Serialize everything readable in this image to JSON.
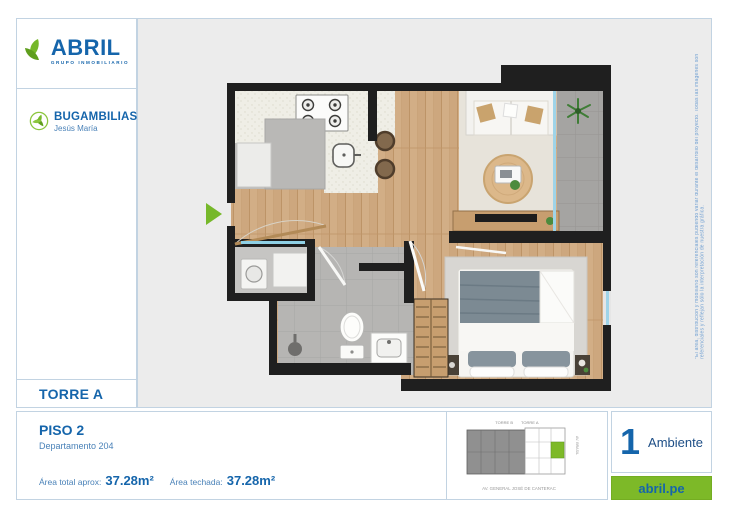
{
  "brand": {
    "name": "ABRIL",
    "tagline": "GRUPO INMOBILIARIO",
    "blue": "#1565ab",
    "green": "#76b82a"
  },
  "project": {
    "name": "BUGAMBILIAS",
    "location": "Jesús María"
  },
  "tower": {
    "label": "TORRE A"
  },
  "unit": {
    "floor": "PISO 2",
    "apartment": "Departamento 204",
    "area_total_label": "Área total aprox:",
    "area_total_value": "37.28m²",
    "area_covered_label": "Área techada:",
    "area_covered_value": "37.28m²"
  },
  "badge": {
    "count": "1",
    "label": "Ambiente"
  },
  "website": {
    "url_label": "abril.pe"
  },
  "keyplan": {
    "top_label_left": "TORRE B",
    "top_label_right": "TORRE A",
    "bottom_street": "AV. GENERAL JOSÉ DE CANTERAC",
    "side_street": "AV. BRASIL"
  },
  "disclaimer": "*El área, distribución y mobiliario son referenciales pudiendo variar durante el desarrollo del proyecto. Todas las imágenes son referenciales y reflejan sólo la interpretación de nuestra gráfica."
}
